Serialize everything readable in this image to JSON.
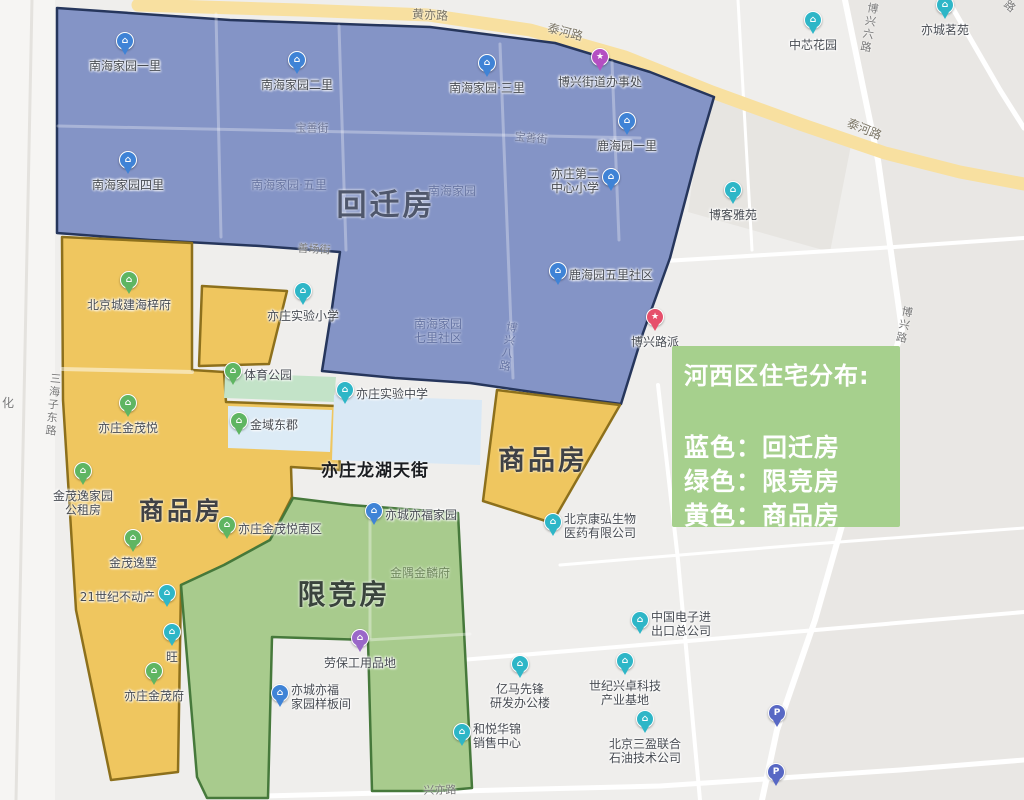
{
  "canvas": {
    "width": 1024,
    "height": 800,
    "bg": "#efeeec"
  },
  "legend": {
    "title": "河西区住宅分布:",
    "lines": [
      "蓝色：回迁房",
      "绿色：限竞房",
      "黄色：商品房"
    ],
    "bg": "#a6d08d",
    "x": 672,
    "y": 346,
    "w": 228,
    "h": 181,
    "color_key": [
      {
        "name": "蓝色",
        "meaning": "回迁房",
        "hex": "#8494c6"
      },
      {
        "name": "绿色",
        "meaning": "限竞房",
        "hex": "#a8cb8d"
      },
      {
        "name": "黄色",
        "meaning": "商品房",
        "hex": "#efc65f"
      }
    ]
  },
  "zones": [
    {
      "id": "zone-huiqianfang-blue",
      "fill": "#8494c6",
      "stroke": "#26365c",
      "points": "57,8 230,20 430,27 555,43 650,72 714,97 699,148 670,258 643,333 621,404 560,396 470,383 395,378 322,371 332,308 340,252 260,246 150,240 57,233"
    },
    {
      "id": "zone-shangpinfang-left-yellow",
      "fill": "#efc65f",
      "stroke": "#8d701c",
      "points": "62,237 192,243 192,370 224,372 226,402 337,406 340,470 291,467 292,497 270,540 224,565 181,585 178,772 111,780 76,610 63,400"
    },
    {
      "id": "zone-yellow-small-quad",
      "fill": "#efc65f",
      "stroke": "#8d701c",
      "points": "202,286 287,291 269,364 199,366"
    },
    {
      "id": "zone-shangpinfang-right-yellow",
      "fill": "#efc65f",
      "stroke": "#8d701c",
      "points": "497,390 620,405 552,523 483,501"
    },
    {
      "id": "zone-xianjingfang-green",
      "fill": "#a8cb8d",
      "stroke": "#46793b",
      "points": "293,498 350,505 458,513 472,788 438,791 372,791 368,640 272,637 268,798 207,798 197,777 181,585 224,565 270,540"
    }
  ],
  "base": {
    "under_blocks": [
      {
        "name": "left-margin-strip",
        "points": "0,0 55,0 55,800 0,800",
        "fill": "#f6f5f3"
      },
      {
        "name": "east-district-fill",
        "points": "845,0 1024,0 1024,800 762,800 777,730 902,330 878,160",
        "fill": "#e9e7e4"
      },
      {
        "name": "building-block",
        "points": "705,95 852,140 830,252 688,212",
        "fill": "#e7e5e1"
      }
    ],
    "roads": [
      {
        "name": "road-sanhaizi-donglu",
        "points": "32,0 24,400 16,800",
        "w": 3,
        "color": "#e4e2de"
      },
      {
        "name": "road-xingyi-lu",
        "points": "225,797 500,790 660,786 900,770 1024,760",
        "w": 5,
        "color": "#ffffff"
      },
      {
        "name": "road-vertical-mid",
        "points": "658,385 678,560 700,800",
        "w": 4,
        "color": "#ffffff"
      },
      {
        "name": "road-horizontal-south",
        "points": "425,663 700,640 1024,612",
        "w": 4,
        "color": "#ffffff"
      },
      {
        "name": "road-horizontal-mid",
        "points": "560,565 800,545 1024,528",
        "w": 3,
        "color": "#ffffff"
      },
      {
        "name": "road-horizontal-north",
        "points": "648,262 880,248 1024,238",
        "w": 4,
        "color": "#ffffff"
      },
      {
        "name": "road-vertical-north",
        "points": "738,0 752,250",
        "w": 3,
        "color": "#ffffff"
      },
      {
        "name": "road-boxing-lu",
        "points": "845,0 878,160 902,330 855,480 815,620 777,730 762,800",
        "w": 6,
        "color": "#ffffff"
      },
      {
        "name": "road-corner-ne",
        "points": "948,0 1000,90 1024,128",
        "w": 5,
        "color": "#ffffff"
      },
      {
        "name": "road-taihe-huangyi",
        "points": "138,5 300,10 428,15 530,30 625,57 712,92 800,124 885,153 960,172 1024,184",
        "w": 13,
        "color": "#f8e0a0"
      }
    ],
    "over_blocks": [
      {
        "name": "tiyu-park-block",
        "points": "225,373 336,377 334,402 224,398",
        "fill": "#c3e3c8"
      },
      {
        "name": "jinyu-dongjun-block",
        "points": "228,406 332,410 330,452 228,448",
        "fill": "#dcebf6"
      },
      {
        "name": "shiyan-school-block",
        "points": "334,395 482,400 480,465 332,460",
        "fill": "#d9e8f5"
      }
    ],
    "grid_lines": [
      {
        "points": "216,14 221,237",
        "w": 3,
        "o": 0.3
      },
      {
        "points": "339,26 346,250",
        "w": 3,
        "o": 0.3
      },
      {
        "points": "500,44 513,378",
        "w": 3,
        "o": 0.3
      },
      {
        "points": "612,62 619,240",
        "w": 3,
        "o": 0.3
      },
      {
        "points": "58,126 640,138",
        "w": 3,
        "o": 0.3
      },
      {
        "points": "62,369 192,372",
        "w": 4,
        "o": 0.5
      },
      {
        "points": "370,515 370,638",
        "w": 3,
        "o": 0.35
      },
      {
        "points": "368,640 470,634",
        "w": 3,
        "o": 0.35
      }
    ]
  },
  "pin_colors": {
    "blue": "#3f83d6",
    "teal": "#2eb6c7",
    "green": "#5fb562",
    "purple": "#9a68c8",
    "magenta": "#b44fc2",
    "red": "#e64f6b",
    "parking": "#5868c4"
  },
  "pin_default_glyph": "⌂",
  "pins": [
    {
      "x": 125,
      "y": 57,
      "type": "blue",
      "lines": [
        "南海家园一里"
      ],
      "pos": "below"
    },
    {
      "x": 297,
      "y": 76,
      "type": "blue",
      "lines": [
        "南海家园二里"
      ],
      "pos": "below"
    },
    {
      "x": 487,
      "y": 79,
      "type": "blue",
      "lines": [
        "南海家园·三里"
      ],
      "pos": "below"
    },
    {
      "x": 627,
      "y": 137,
      "type": "blue",
      "lines": [
        "鹿海园一里"
      ],
      "pos": "below"
    },
    {
      "x": 128,
      "y": 176,
      "type": "blue",
      "lines": [
        "南海家园四里"
      ],
      "pos": "below"
    },
    {
      "x": 611,
      "y": 193,
      "type": "blue",
      "lines": [
        "亦庄第二",
        "中心小学"
      ],
      "pos": "left"
    },
    {
      "x": 558,
      "y": 287,
      "type": "blue",
      "lines": [
        "鹿海园五里社区"
      ],
      "pos": "right"
    },
    {
      "x": 374,
      "y": 527,
      "type": "blue",
      "lines": [
        "亦城亦福家园"
      ],
      "pos": "right"
    },
    {
      "x": 280,
      "y": 709,
      "type": "blue",
      "lines": [
        "亦城亦福",
        "家园样板间"
      ],
      "pos": "right"
    },
    {
      "x": 600,
      "y": 73,
      "type": "magenta",
      "glyph": "★",
      "lines": [
        "博兴街道办事处"
      ],
      "pos": "below"
    },
    {
      "x": 655,
      "y": 333,
      "type": "red",
      "glyph": "★",
      "lines": [
        "博兴路派"
      ],
      "pos": "below"
    },
    {
      "x": 813,
      "y": 36,
      "type": "teal",
      "lines": [
        "中芯花园"
      ],
      "pos": "below"
    },
    {
      "x": 945,
      "y": 21,
      "type": "teal",
      "lines": [
        "亦城茗苑"
      ],
      "pos": "below"
    },
    {
      "x": 733,
      "y": 206,
      "type": "teal",
      "lines": [
        "博客雅苑"
      ],
      "pos": "below"
    },
    {
      "x": 303,
      "y": 307,
      "type": "teal",
      "lines": [
        "亦庄实验小学"
      ],
      "pos": "below"
    },
    {
      "x": 345,
      "y": 406,
      "type": "teal",
      "lines": [
        "亦庄实验中学"
      ],
      "pos": "right"
    },
    {
      "x": 167,
      "y": 609,
      "type": "teal",
      "lines": [
        "21世纪不动产"
      ],
      "pos": "left"
    },
    {
      "x": 172,
      "y": 648,
      "type": "teal",
      "lines": [
        "旺"
      ],
      "pos": "below"
    },
    {
      "x": 553,
      "y": 538,
      "type": "teal",
      "lines": [
        "北京康弘生物",
        "医药有限公司"
      ],
      "pos": "right"
    },
    {
      "x": 640,
      "y": 636,
      "type": "teal",
      "lines": [
        "中国电子进",
        "出口总公司"
      ],
      "pos": "right"
    },
    {
      "x": 520,
      "y": 680,
      "type": "teal",
      "lines": [
        "亿马先锋",
        "研发办公楼"
      ],
      "pos": "below"
    },
    {
      "x": 625,
      "y": 677,
      "type": "teal",
      "lines": [
        "世纪兴卓科技",
        "产业基地"
      ],
      "pos": "below"
    },
    {
      "x": 645,
      "y": 735,
      "type": "teal",
      "lines": [
        "北京三盈联合",
        "石油技术公司"
      ],
      "pos": "below"
    },
    {
      "x": 462,
      "y": 748,
      "type": "teal",
      "lines": [
        "和悦华锦",
        "销售中心"
      ],
      "pos": "right"
    },
    {
      "x": 129,
      "y": 296,
      "type": "green",
      "lines": [
        "北京城建海梓府"
      ],
      "pos": "below"
    },
    {
      "x": 233,
      "y": 387,
      "type": "green",
      "lines": [
        "体育公园"
      ],
      "pos": "right"
    },
    {
      "x": 128,
      "y": 419,
      "type": "green",
      "lines": [
        "亦庄金茂悦"
      ],
      "pos": "below"
    },
    {
      "x": 239,
      "y": 437,
      "type": "green",
      "lines": [
        "金域东郡"
      ],
      "pos": "right"
    },
    {
      "x": 83,
      "y": 487,
      "type": "green",
      "lines": [
        "金茂逸家园",
        "公租房"
      ],
      "pos": "below"
    },
    {
      "x": 227,
      "y": 541,
      "type": "green",
      "lines": [
        "亦庄金茂悦南区"
      ],
      "pos": "right"
    },
    {
      "x": 133,
      "y": 554,
      "type": "green",
      "lines": [
        "金茂逸墅"
      ],
      "pos": "below"
    },
    {
      "x": 154,
      "y": 687,
      "type": "green",
      "lines": [
        "亦庄金茂府"
      ],
      "pos": "below"
    },
    {
      "x": 360,
      "y": 654,
      "type": "purple",
      "lines": [
        "劳保工用品地"
      ],
      "pos": "below"
    },
    {
      "x": 777,
      "y": 729,
      "type": "parking",
      "glyph": "P",
      "lines": [],
      "pos": "none"
    },
    {
      "x": 776,
      "y": 788,
      "type": "parking",
      "glyph": "P",
      "lines": [],
      "pos": "none"
    }
  ],
  "labels": [
    {
      "kind": "zone",
      "text": "回迁房",
      "x": 386,
      "y": 206,
      "size": 30,
      "color": "#4f576c",
      "weight": 700,
      "ls": 3
    },
    {
      "kind": "zone",
      "text": "商品房",
      "x": 543,
      "y": 461,
      "size": 27,
      "color": "#3f4145",
      "weight": 700,
      "ls": 3
    },
    {
      "kind": "zone",
      "text": "商品房",
      "x": 181,
      "y": 512,
      "size": 25,
      "color": "#3f4145",
      "weight": 700,
      "ls": 3
    },
    {
      "kind": "zone",
      "text": "限竞房",
      "x": 344,
      "y": 595,
      "size": 28,
      "color": "#3a443d",
      "weight": 700,
      "ls": 3
    },
    {
      "kind": "street-major",
      "text": "亦庄龙湖天街",
      "x": 375,
      "y": 472,
      "size": 17,
      "color": "#1b1d21",
      "weight": 700,
      "ls": 1
    },
    {
      "kind": "faint",
      "text": "南海家园·五里",
      "x": 289,
      "y": 186,
      "size": 12,
      "color": "#5f6b96",
      "opacity": 0.75
    },
    {
      "kind": "faint",
      "text": "南海家园",
      "x": 452,
      "y": 192,
      "size": 12,
      "color": "#5f6b96",
      "opacity": 0.7
    },
    {
      "kind": "faint",
      "lines": [
        "南海家园",
        "七里社区"
      ],
      "x": 438,
      "y": 332,
      "size": 12,
      "color": "#5c6a9a",
      "opacity": 0.8
    },
    {
      "kind": "faint",
      "text": "博兴八路",
      "x": 507,
      "y": 347,
      "size": 11,
      "color": "#5c6a9a",
      "opacity": 0.8,
      "vertical": true,
      "rotate": 10
    },
    {
      "kind": "faint",
      "text": "金隅金麟府",
      "x": 420,
      "y": 574,
      "size": 12,
      "color": "#667d55",
      "opacity": 0.85
    },
    {
      "kind": "road",
      "text": "宝善街",
      "x": 312,
      "y": 129,
      "size": 11,
      "color": "#6c7596"
    },
    {
      "kind": "road",
      "text": "宝善街",
      "x": 531,
      "y": 139,
      "size": 11,
      "color": "#6c7596",
      "rotate": 6
    },
    {
      "kind": "road",
      "text": "善场街",
      "x": 314,
      "y": 250,
      "size": 11,
      "color": "#787878",
      "rotate": 3
    },
    {
      "kind": "road",
      "text": "三海子东路",
      "x": 52,
      "y": 405,
      "size": 11,
      "color": "#787878",
      "vertical": true,
      "rotate": 5
    },
    {
      "kind": "road",
      "text": "化",
      "x": 8,
      "y": 404,
      "size": 12,
      "color": "#787878"
    },
    {
      "kind": "road",
      "text": "兴亦路",
      "x": 440,
      "y": 791,
      "size": 11,
      "color": "#787878",
      "rotate": -1
    },
    {
      "kind": "road",
      "text": "黄亦路",
      "x": 430,
      "y": 16,
      "size": 12,
      "color": "#7a7464",
      "rotate": 3
    },
    {
      "kind": "road",
      "text": "泰河路",
      "x": 565,
      "y": 33,
      "size": 12,
      "color": "#7a7464",
      "rotate": 15
    },
    {
      "kind": "road",
      "text": "泰河路",
      "x": 864,
      "y": 130,
      "size": 12,
      "color": "#7a7464",
      "rotate": 22
    },
    {
      "kind": "road",
      "text": "博兴六路",
      "x": 868,
      "y": 28,
      "size": 11,
      "color": "#787878",
      "vertical": true,
      "rotate": 10
    },
    {
      "kind": "road",
      "text": "博兴路",
      "x": 903,
      "y": 325,
      "size": 11,
      "color": "#787878",
      "vertical": true,
      "rotate": 12
    },
    {
      "kind": "road",
      "text": "路",
      "x": 1009,
      "y": 7,
      "size": 11,
      "color": "#787878",
      "rotate": 40
    },
    {
      "kind": "park",
      "text": "体育公园",
      "x": 270,
      "y": 389,
      "size": 0,
      "color": "",
      "hidden": true
    }
  ]
}
